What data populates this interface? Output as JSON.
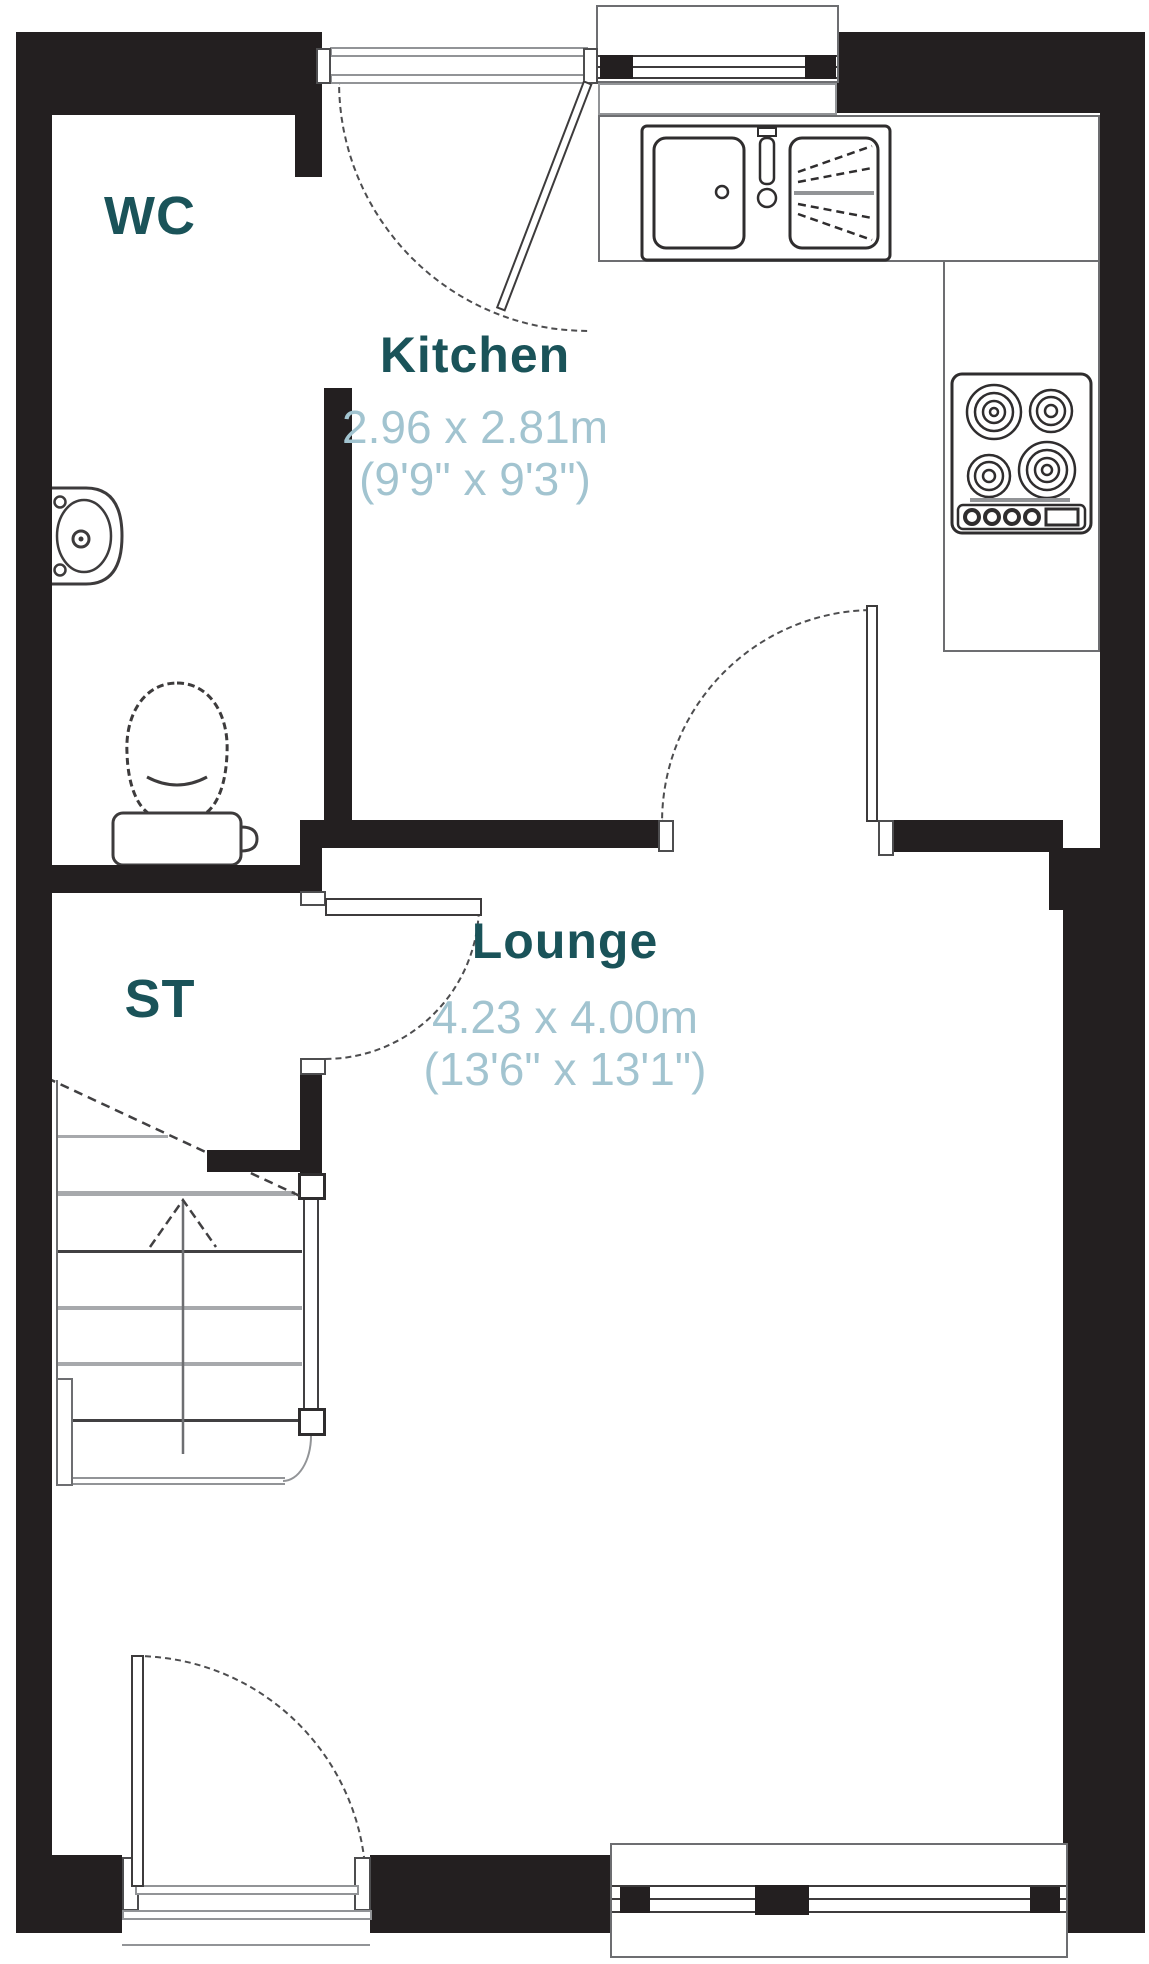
{
  "rooms": {
    "wc": {
      "label": "WC"
    },
    "kitchen": {
      "label": "Kitchen",
      "dims_metric": "2.96 x 2.81m",
      "dims_imperial": "(9'9\" x 9'3\")"
    },
    "storage": {
      "label": "ST"
    },
    "lounge": {
      "label": "Lounge",
      "dims_metric": "4.23 x 4.00m",
      "dims_imperial": "(13'6\" x 13'1\")"
    }
  },
  "colors": {
    "wall": "#231f20",
    "room_label": "#1a5359",
    "dims_label": "#a2c4d0",
    "thin_line": "#58595b"
  }
}
